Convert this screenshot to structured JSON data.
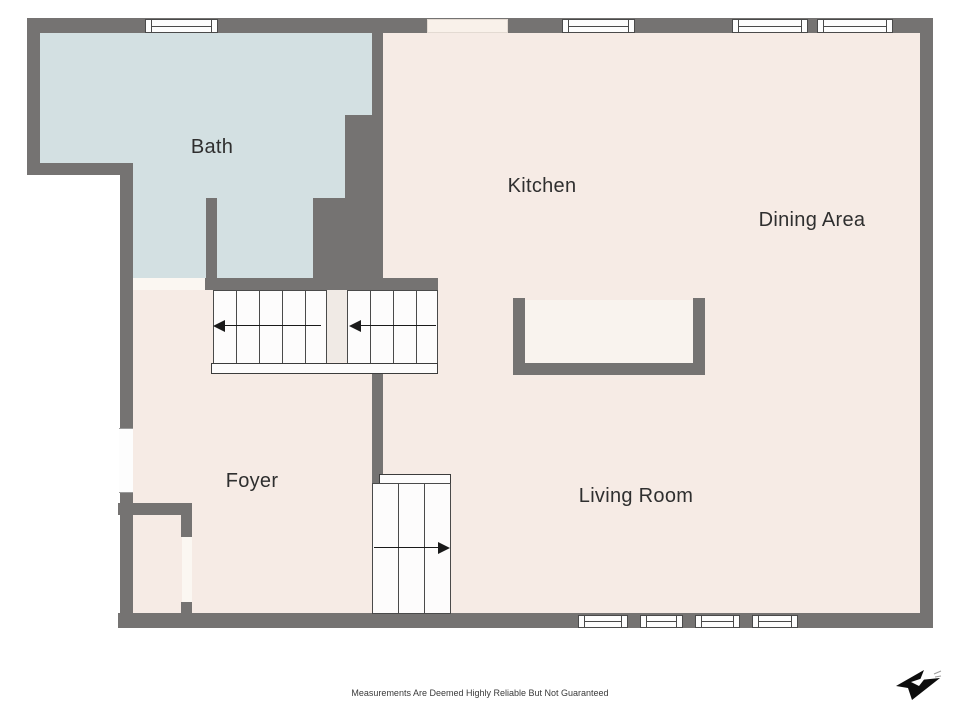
{
  "title": "First floor plan",
  "rooms": [
    {
      "id": "bath",
      "label": "Bath"
    },
    {
      "id": "kitchen",
      "label": "Kitchen"
    },
    {
      "id": "dining",
      "label": "Dining Area"
    },
    {
      "id": "foyer",
      "label": "Foyer"
    },
    {
      "id": "living",
      "label": "Living Room"
    }
  ],
  "stairs": {
    "upper_left_flight_direction": "left",
    "upper_right_flight_direction": "left",
    "lower_flight_direction": "right"
  },
  "icons": {
    "stair_arrow_left": "left-triangle",
    "stair_arrow_right": "right-triangle",
    "compass": "north-arrow-logo"
  },
  "footer": {
    "disclaimer": "Measurements Are Deemed Highly Reliable But Not Guaranteed"
  },
  "colors": {
    "wall": "#757372",
    "floor": "#f6ebe5",
    "bath_floor": "#d3e0e2",
    "stair_fill": "#fdfcfc",
    "stair_line": "#4a4a4a",
    "divider_fill": "#f0eae5",
    "window_fill": "#fdfdfd",
    "opening_fill": "#f9f1ea",
    "door_fill": "#fbf7f2",
    "counter_inner": "#f9f3ee",
    "label_text": "#2f2f2f",
    "disclaimer_text": "#3a3a3a",
    "logo": "#0d0d0d"
  }
}
